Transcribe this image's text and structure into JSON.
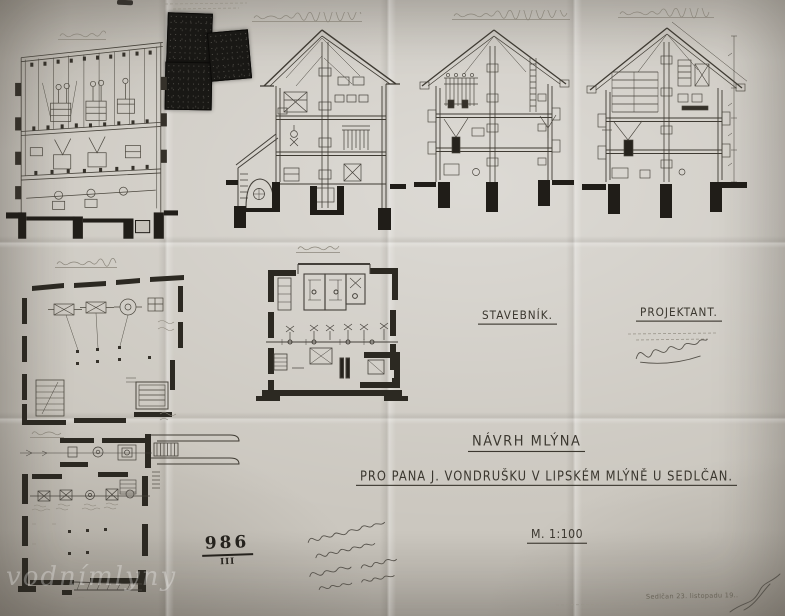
{
  "sheet": {
    "title": "NÁVRH MLÝNA",
    "client_line": "PRO PANA  J. VONDRUŠKU  V LIPSKÉM MLÝNĚ U SEDLČAN.",
    "scale": "M. 1:100",
    "builder_heading": "STAVEBNÍK.",
    "designer_heading": "PROJEKTANT.",
    "registry_number": "986",
    "registry_roman": "III",
    "date_note": "Sedlčan 23. listopadu 19..",
    "watermark": "vodnímlyny"
  },
  "colors": {
    "paper": "#cbc7bf",
    "ink": "#332f28",
    "pencil": "#8b867b",
    "stamp_dark": "#191815"
  }
}
